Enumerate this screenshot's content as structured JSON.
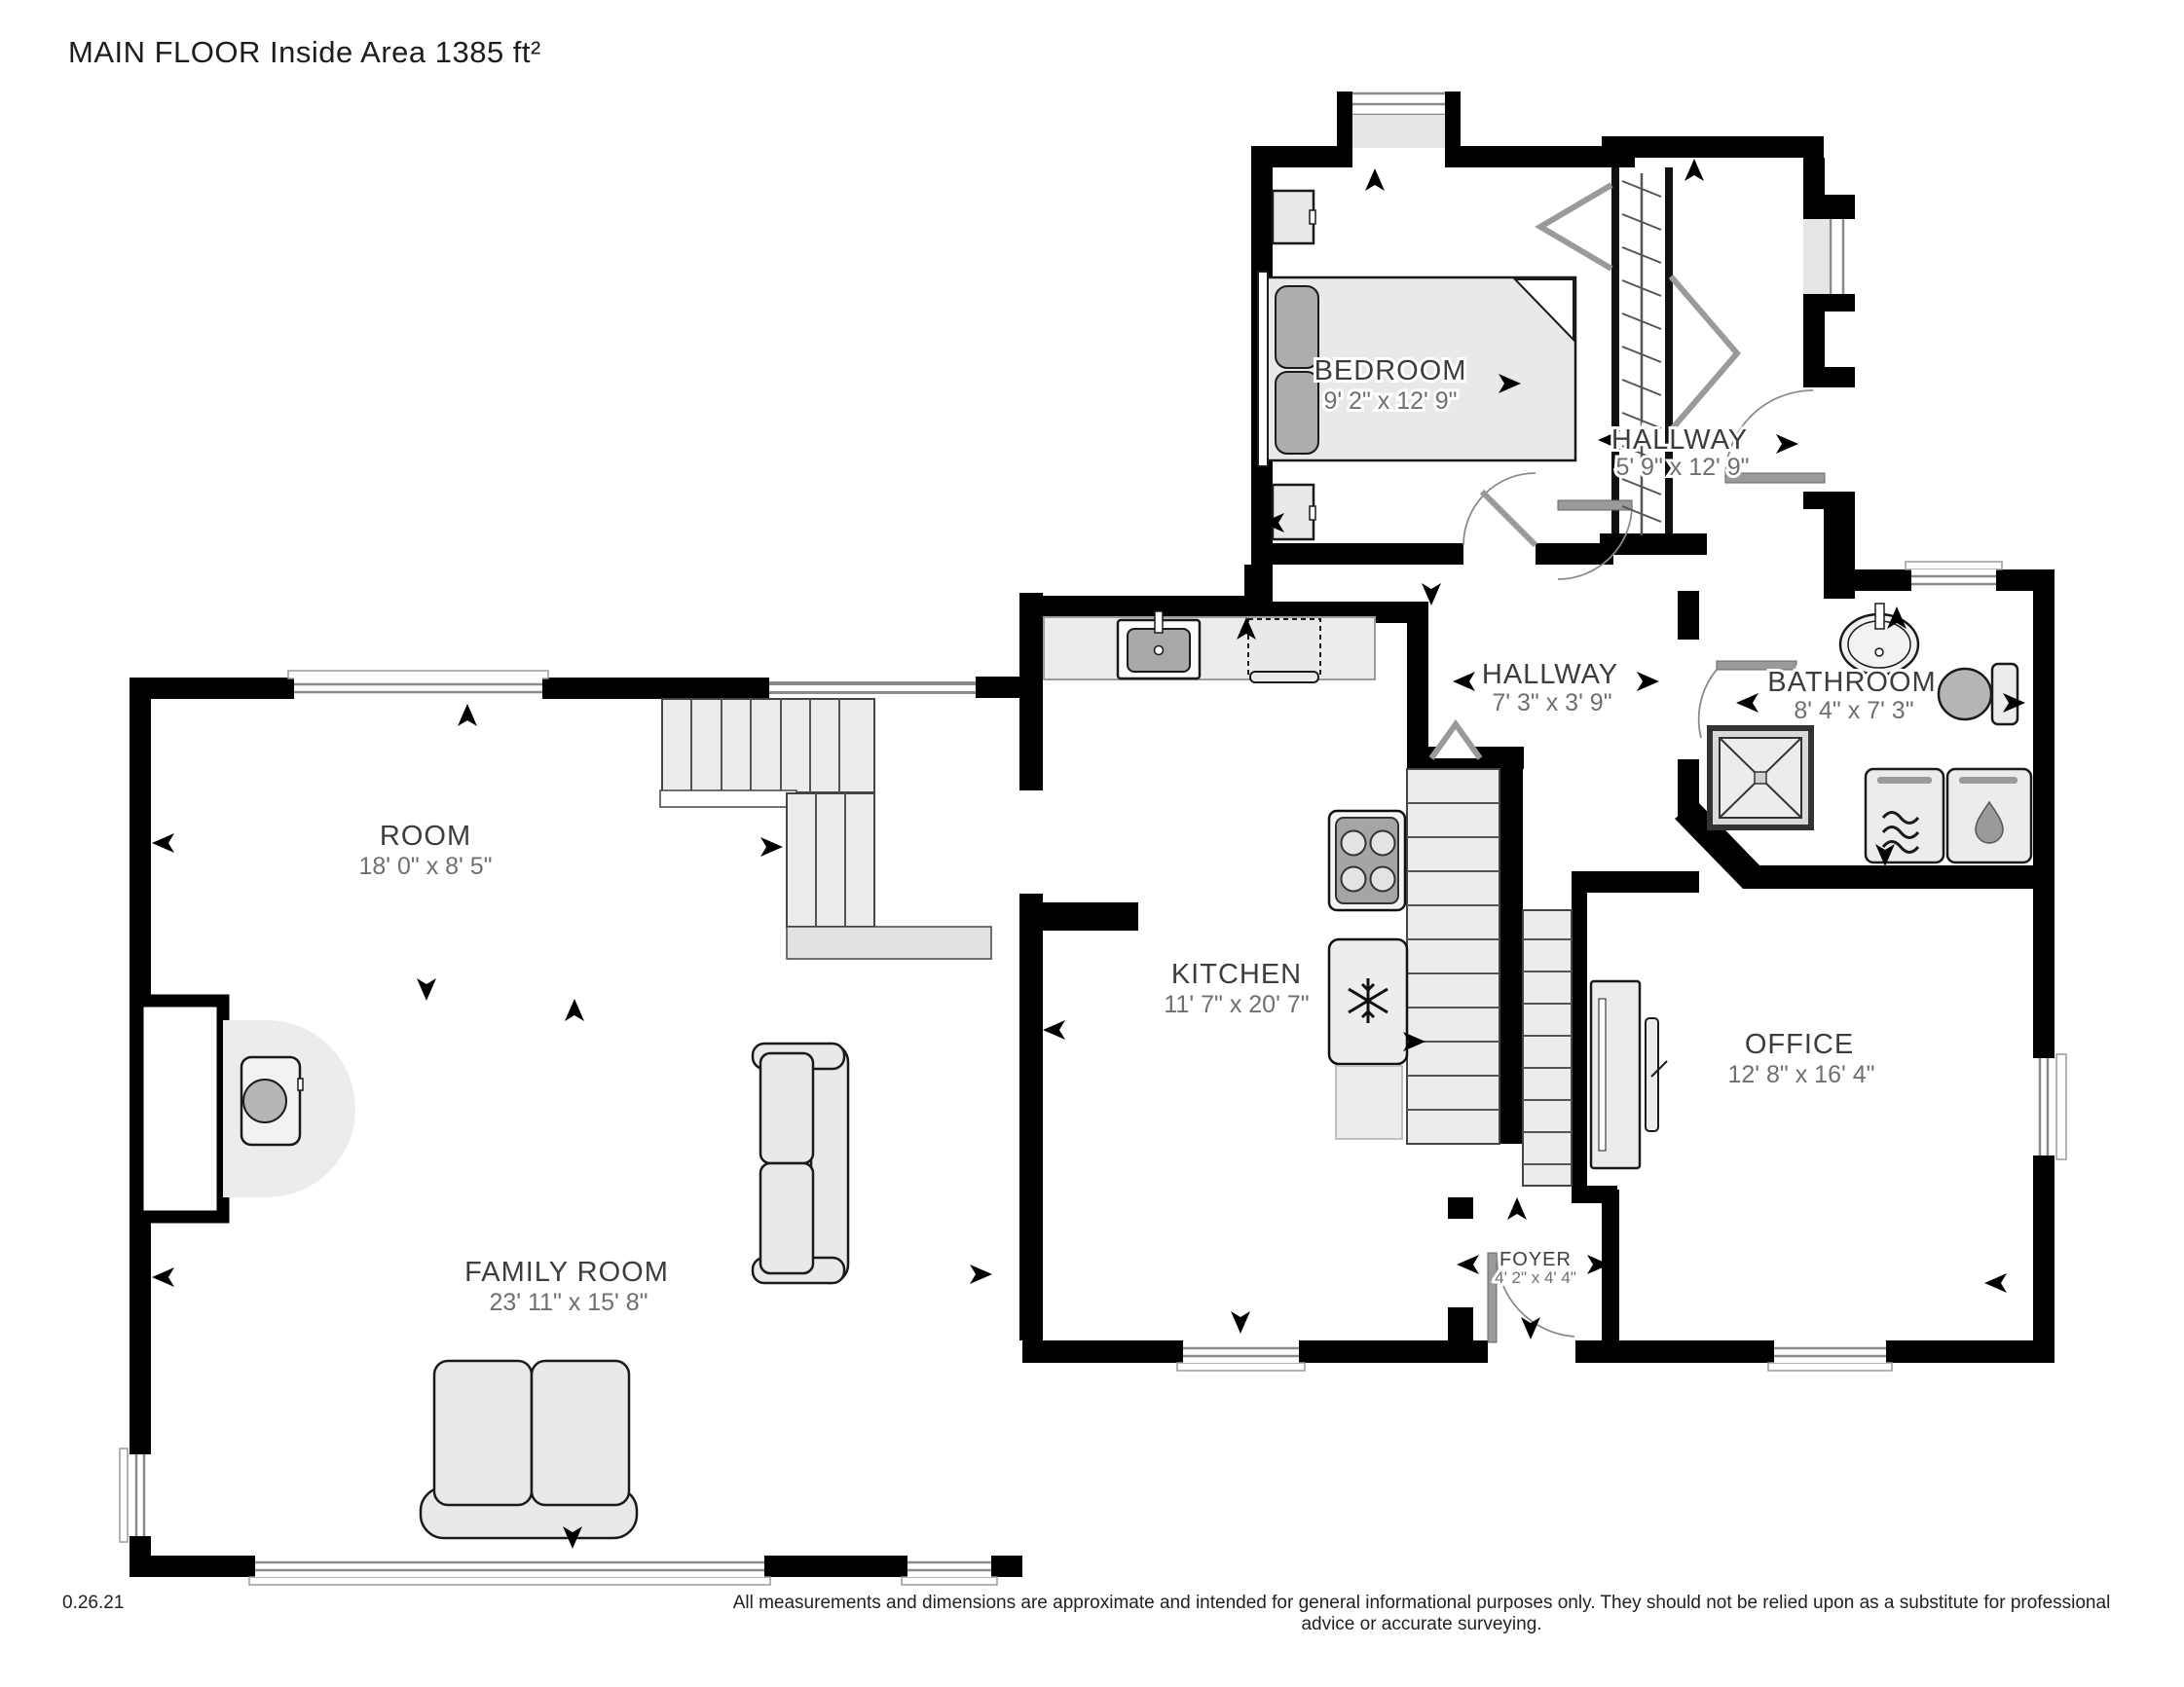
{
  "title": "MAIN FLOOR Inside Area 1385 ft²",
  "footer": {
    "date_code": "0.26.21",
    "disclaimer": "All measurements and dimensions are approximate and intended for general informational purposes only. They should not be relied upon as a substitute for professional advice or accurate surveying."
  },
  "rooms": {
    "bedroom": {
      "name": "BEDROOM",
      "dims": "9' 2\" x 12' 9\""
    },
    "hallway_upper": {
      "name": "HALLWAY",
      "dims": "5' 9\" x 12' 9\""
    },
    "hallway_main": {
      "name": "HALLWAY",
      "dims": "7' 3\" x 3' 9\""
    },
    "bathroom": {
      "name": "BATHROOM",
      "dims": "8' 4\" x 7' 3\""
    },
    "room": {
      "name": "ROOM",
      "dims": "18' 0\" x 8' 5\""
    },
    "kitchen": {
      "name": "KITCHEN",
      "dims": "11' 7\" x 20' 7\""
    },
    "office": {
      "name": "OFFICE",
      "dims": "12' 8\" x 16' 4\""
    },
    "family_room": {
      "name": "FAMILY ROOM",
      "dims": "23' 11\" x 15' 8\""
    },
    "foyer": {
      "name": "FOYER",
      "dims": "4' 2\" x 4' 4\""
    }
  },
  "icons": [
    "photo-direction-arrow",
    "snowflake-icon",
    "water-drop-icon",
    "wash-waves-icon",
    "hanger-rod-icon"
  ],
  "colors": {
    "wall": "#000000",
    "furniture": "#e9e9e9",
    "accent": "#adadad",
    "label": "#3d3d3d",
    "dims": "#6f6f6f",
    "door": "#9a9a9a"
  }
}
